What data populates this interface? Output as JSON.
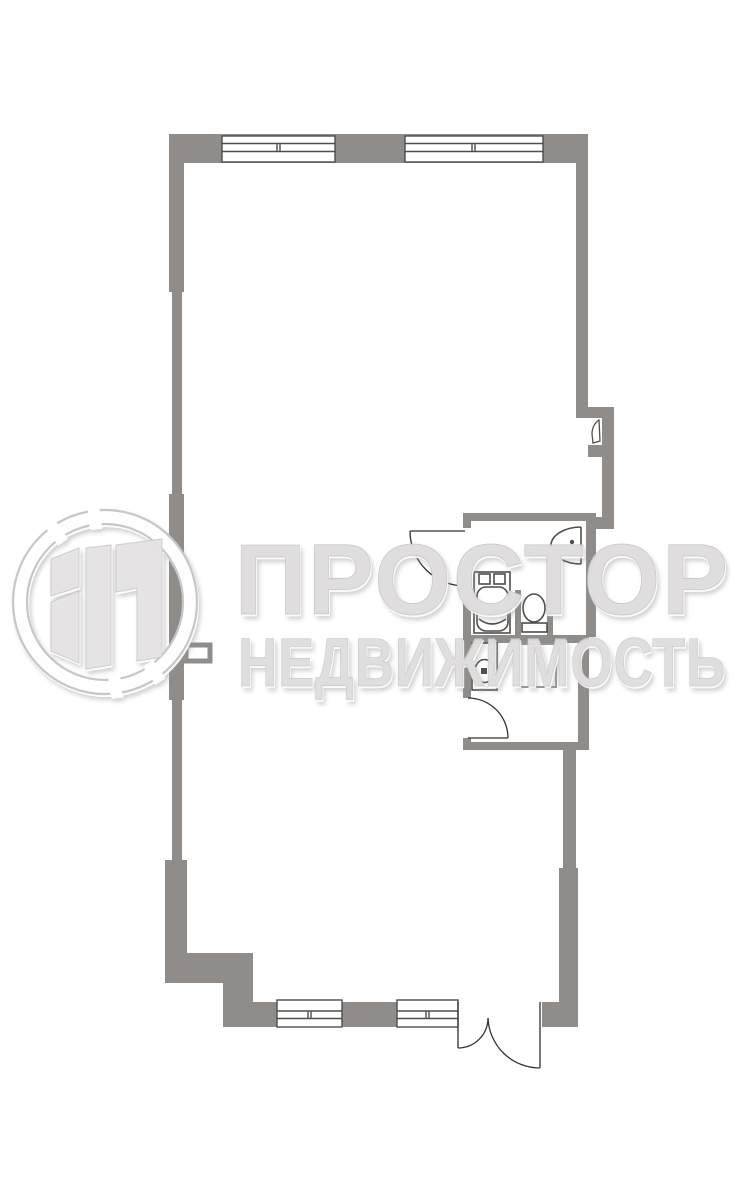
{
  "meta": {
    "kind": "real-estate floor plan",
    "background": "#ffffff"
  },
  "watermark": {
    "line1": "ПРОСТОР",
    "line2": "НЕДВИЖИМОСТЬ",
    "logo": "ring-with-door-monogram"
  },
  "colors": {
    "wall": "#8f8c89",
    "line": "#4f4e4c",
    "door": "#333333",
    "shower": "#9a9896",
    "white": "#ffffff",
    "watermark_fill": "#dcdada",
    "watermark_stroke": "#c8c6c6",
    "logo_panel": "#e4e2e2",
    "logo_ring": "#c8c6c6"
  },
  "plan": {
    "windows_top_count": 2,
    "windows_bottom_count": 2,
    "icons": {
      "washing-machine-icon": "rect with two knobs and rounded drum",
      "toilet-icon": "oval bowl with cistern",
      "wall-sink-icon": "half-oval basin with tap dot",
      "pedestal-basin-icon": "rect with round bowl and drain square",
      "shower-tray-icon": "light square outline",
      "radiator-icon": "small open rectangle on left wall",
      "casement-icon": "curved wedge in wall niche",
      "door-arc-icon": "quarter-circle swing arc"
    }
  }
}
